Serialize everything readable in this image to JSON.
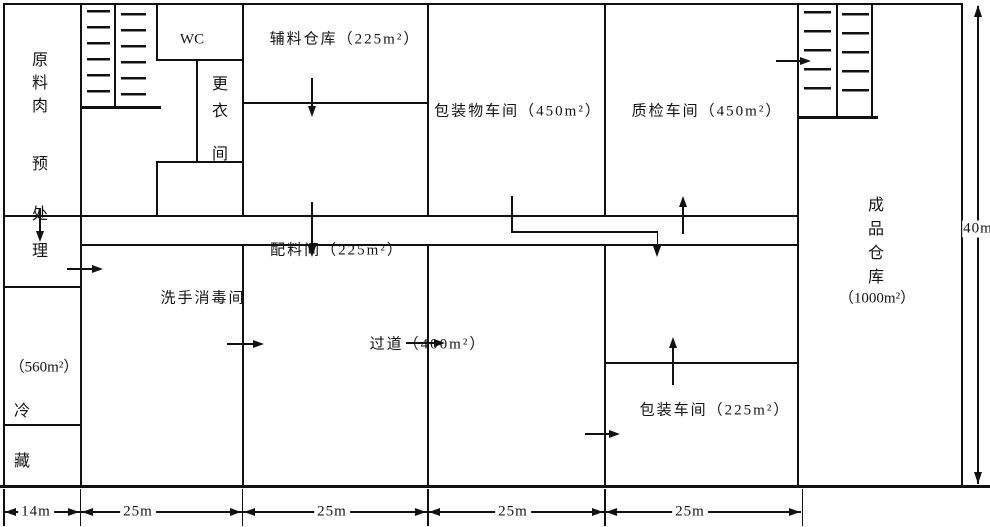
{
  "diagram_type": "factory-floor-plan",
  "rooms": {
    "raw_meat_pretreatment": {
      "line1": "原料肉",
      "line2": "预处",
      "line3": "理"
    },
    "cold_storage": {
      "area": "（560m²）",
      "char1": "冷",
      "char2": "藏"
    },
    "wc": {
      "label": "WC"
    },
    "changing_room": {
      "line1": "更衣",
      "line2": "间"
    },
    "auxiliary_warehouse": {
      "label": "辅料仓库（225m²）"
    },
    "packaging_material_workshop": {
      "label": "包装物车间（450m²）"
    },
    "qc_workshop": {
      "label": "质检车间（450m²）"
    },
    "ingredient_room": {
      "label": "配料间（225m²）"
    },
    "handwash_room": {
      "label": "洗手消毒间"
    },
    "corridor": {
      "label": "过道（400m²）"
    },
    "packing_workshop": {
      "label": "包装车间（225m²）"
    },
    "finished_goods_warehouse": {
      "vertical": "成品仓库",
      "area": "（1000m²）"
    }
  },
  "dimensions": {
    "bottom": [
      "14m",
      "25m",
      "25m",
      "25m",
      "25m"
    ],
    "right": "40m"
  },
  "colors": {
    "line": "#111111",
    "background": "#ffffff",
    "text": "#141414"
  }
}
